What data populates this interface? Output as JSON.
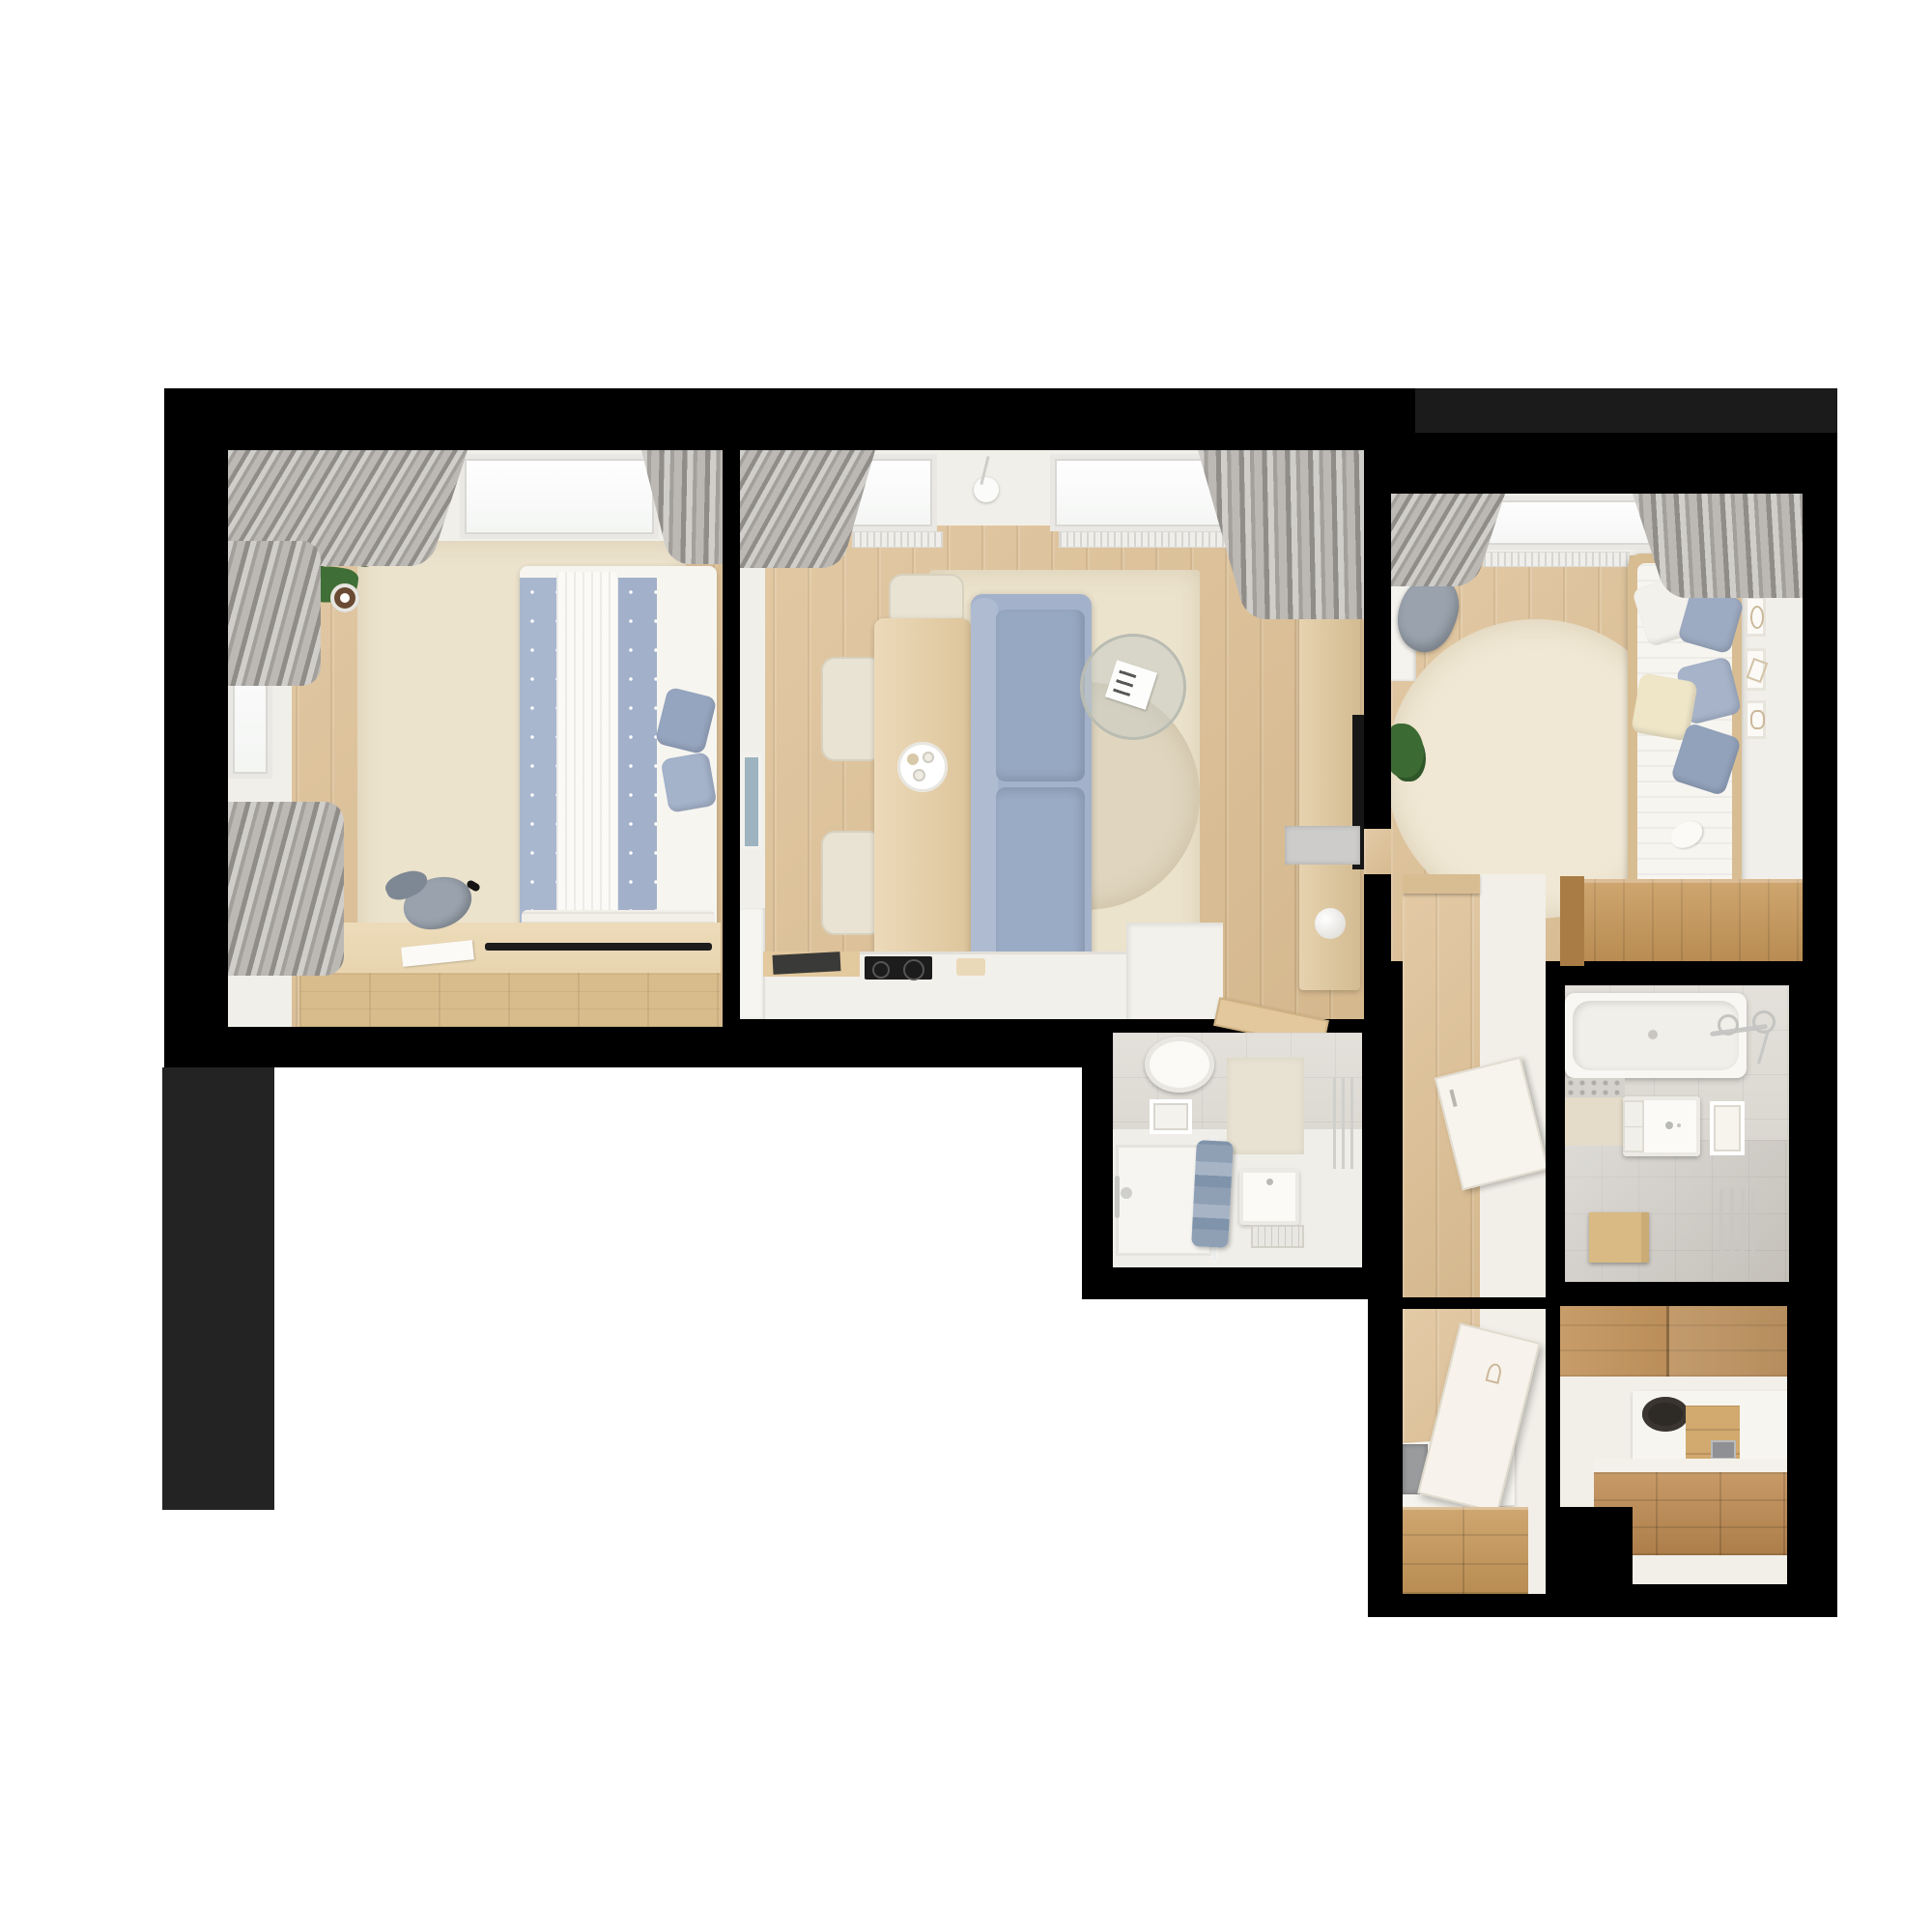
{
  "scene": {
    "title": "apartment-floor-plan-3d-render",
    "type": "top-down 3D rendered floor plan on white background",
    "background": "#ffffff",
    "wall_color": "#000000",
    "shadow_block_color": "#232323"
  },
  "palette": {
    "floor_wood": "#ddbf93",
    "cabinet_wood": "#bf8c50",
    "table_wood": "#e6cda2",
    "rug_cream": "#ece3cd",
    "rug_inner": "#e0d6bf",
    "sofa_blue": "#9fafc7",
    "bedding_blue": "#a9b7ce",
    "soft_white": "#f5f3ee",
    "curtain_gray": "#aaa7a3",
    "tile_gray": "#d9d5cd",
    "plant_green": "#386230",
    "chair_gray": "#99a2ad",
    "tv_black": "#161616",
    "chrome": "#c7c7c5"
  },
  "rooms": [
    {
      "name": "bedroom",
      "furniture": [
        "double-bed",
        "blue-throw-blankets",
        "pillows",
        "area-rug",
        "potted-plant",
        "desk",
        "keyboard-tray",
        "office-chair",
        "windows",
        "radiator",
        "curtains"
      ]
    },
    {
      "name": "living-room-kitchen",
      "furniture": [
        "dining-table",
        "serving-tray",
        "dining-chairs",
        "sofa",
        "area-rug",
        "coffee-table",
        "floor-lamp",
        "tv-bench",
        "decor-sphere",
        "tv",
        "wall-cabinet",
        "picture-frame",
        "kitchen-counter",
        "cooktop",
        "cutting-board",
        "tall-cabinet",
        "doormat",
        "windows",
        "radiators",
        "curtains",
        "open-door"
      ]
    },
    {
      "name": "kids-bedroom",
      "furniture": [
        "single-bed",
        "pillows",
        "plush-toy",
        "bed-lamp",
        "round-rug",
        "desk-ledge",
        "desk-chair",
        "wall-frames",
        "wardrobe",
        "plant",
        "window",
        "radiator",
        "curtains"
      ]
    },
    {
      "name": "shower-room",
      "furniture": [
        "toilet",
        "wall-niche",
        "washbasin",
        "floor-drain",
        "shower-tray",
        "shower-screen",
        "towels",
        "towel-rail",
        "wall-panel"
      ]
    },
    {
      "name": "hallway",
      "furniture": [
        "wood-floor",
        "shelf",
        "open-door",
        "side-cabinet",
        "doormat"
      ]
    },
    {
      "name": "bathroom",
      "furniture": [
        "bathtub",
        "bath-faucet",
        "toiletry-shelf",
        "vanity-sink",
        "mirror",
        "towel-radiator",
        "wooden-stool"
      ]
    },
    {
      "name": "walk-in-closet",
      "furniture": [
        "folding-panel",
        "bench-counter",
        "laundry-basket",
        "storage-drawers"
      ]
    },
    {
      "name": "entry-hall",
      "furniture": [
        "upper-cabinets",
        "counter",
        "hat",
        "shelf-steps",
        "storage-drawers"
      ]
    }
  ]
}
